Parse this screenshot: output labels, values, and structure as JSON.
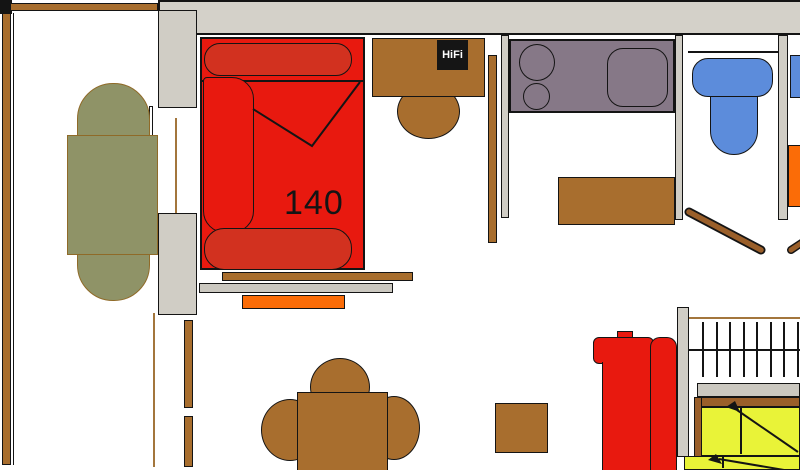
{
  "labels": {
    "bed_size": "140",
    "hifi": "HiFi"
  },
  "colors": {
    "red": "#e8190f",
    "red_dark": "#d2311f",
    "brown": "#a86e2e",
    "stair_brown": "#9a5f2a",
    "tan": "#a3763c",
    "olive": "#8f9367",
    "olive_border": "#8f6a28",
    "mauve": "#867887",
    "blue": "#5c8cdb",
    "orange": "#fb6c07",
    "yellow": "#e9f338",
    "wall": "#d4d1c9",
    "wall_light": "#d0cdc5",
    "wall_bar": "#cbc8c0",
    "outline": "#141414"
  }
}
